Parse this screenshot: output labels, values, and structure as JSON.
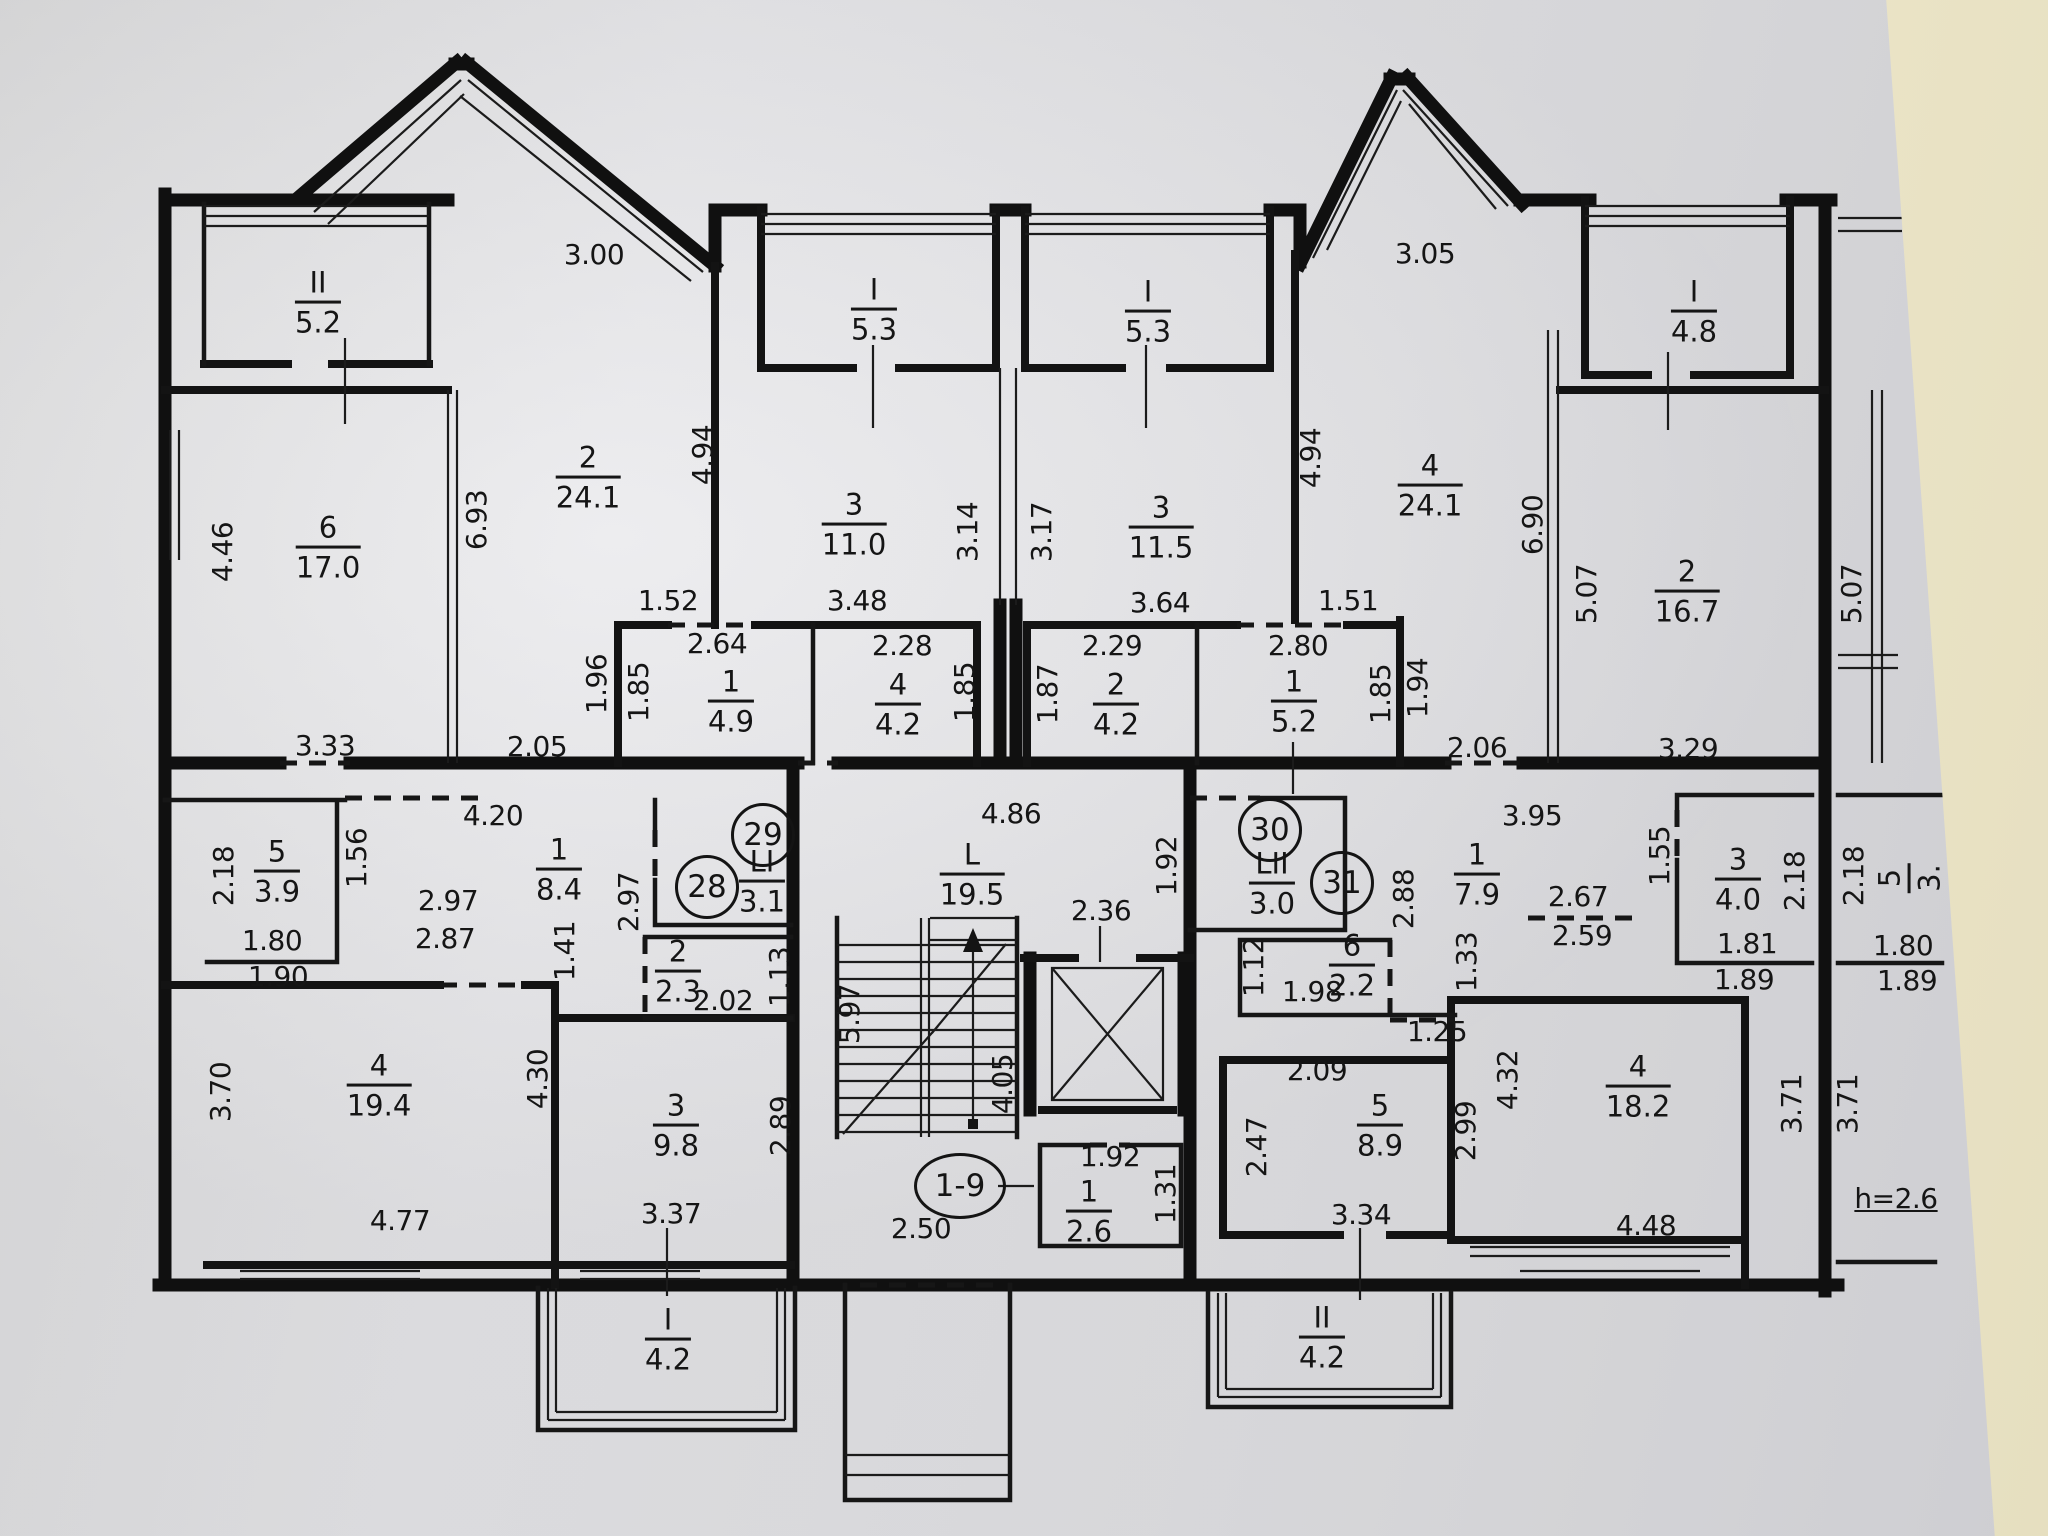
{
  "palette": {
    "paper": "#e3e3e6",
    "wall_behind": "#ece5c8",
    "ink": "#141414"
  },
  "ceiling_height": "h=2.6",
  "entrance": {
    "units": "1-9"
  },
  "apartment_numbers": {
    "a28": "28",
    "a29": "29",
    "a30": "30",
    "a31": "31"
  },
  "rooms": {
    "balcony_II_52": {
      "n": "II",
      "a": "5.2"
    },
    "loggia_I_53_left": {
      "n": "I",
      "a": "5.3"
    },
    "loggia_I_53_right": {
      "n": "I",
      "a": "5.3"
    },
    "balcony_I_48": {
      "n": "I",
      "a": "4.8"
    },
    "room6_170": {
      "n": "6",
      "a": "17.0"
    },
    "room2_241": {
      "n": "2",
      "a": "24.1"
    },
    "room3_110": {
      "n": "3",
      "a": "11.0"
    },
    "room3_115": {
      "n": "3",
      "a": "11.5"
    },
    "room4_241": {
      "n": "4",
      "a": "24.1"
    },
    "room2_167": {
      "n": "2",
      "a": "16.7"
    },
    "room1_49": {
      "n": "1",
      "a": "4.9"
    },
    "room4_42": {
      "n": "4",
      "a": "4.2"
    },
    "room2_42": {
      "n": "2",
      "a": "4.2"
    },
    "room1_52": {
      "n": "1",
      "a": "5.2"
    },
    "room5_39": {
      "n": "5",
      "a": "3.9"
    },
    "room1_84": {
      "n": "1",
      "a": "8.4"
    },
    "wc_LI": {
      "n": "LI",
      "a": "3.1"
    },
    "wc_LII": {
      "n": "LII",
      "a": "3.0"
    },
    "room1_79": {
      "n": "1",
      "a": "7.9"
    },
    "room2_23": {
      "n": "2",
      "a": "2.3"
    },
    "room6_22": {
      "n": "6",
      "a": "2.2"
    },
    "stair_L": {
      "n": "L",
      "a": "19.5"
    },
    "room4_194": {
      "n": "4",
      "a": "19.4"
    },
    "room3_98": {
      "n": "3",
      "a": "9.8"
    },
    "room1_26": {
      "n": "1",
      "a": "2.6"
    },
    "room5_89": {
      "n": "5",
      "a": "8.9"
    },
    "room4_182": {
      "n": "4",
      "a": "18.2"
    },
    "room3_40": {
      "n": "3",
      "a": "4.0"
    },
    "balcony_I_42": {
      "n": "I",
      "a": "4.2"
    },
    "balcony_II_42": {
      "n": "II",
      "a": "4.2"
    },
    "room_clipped": {
      "n": "5",
      "a": "3."
    }
  },
  "dims": {
    "d300": "3.00",
    "d305": "3.05",
    "d446": "4.46",
    "d693": "6.93",
    "d494a": "4.94",
    "d494b": "4.94",
    "d314": "3.14",
    "d317": "3.17",
    "d690": "6.90",
    "d507a": "5.07",
    "d507b": "5.07",
    "d152": "1.52",
    "d264": "2.64",
    "d348": "3.48",
    "d228": "2.28",
    "d364": "3.64",
    "d229": "2.29",
    "d151": "1.51",
    "d280": "2.80",
    "d196": "1.96",
    "d185a": "1.85",
    "d185b": "1.85",
    "d185c": "1.85",
    "d187": "1.87",
    "d194": "1.94",
    "d333": "3.33",
    "d205": "2.05",
    "d206": "2.06",
    "d329": "3.29",
    "d420": "4.20",
    "d395": "3.95",
    "d486": "4.86",
    "d218a": "2.18",
    "d218b": "2.18",
    "d218c": "2.18",
    "d156": "1.56",
    "d297a": "2.97",
    "d297b": "2.97",
    "d287": "2.87",
    "d180a": "1.80",
    "d180b": "1.80",
    "d190": "1.90",
    "d189a": "1.89",
    "d189b": "1.89",
    "d141": "1.41",
    "d202": "2.02",
    "d113": "1.13",
    "d192a": "1.92",
    "d192b": "1.92",
    "d288": "2.88",
    "d236": "2.36",
    "d267": "2.67",
    "d259": "2.59",
    "d155": "1.55",
    "d181": "1.81",
    "d112": "1.12",
    "d198": "1.98",
    "d125": "1.25",
    "d133": "1.33",
    "d370": "3.70",
    "d430": "4.30",
    "d289": "2.89",
    "d597": "5.97",
    "d405": "4.05",
    "d209": "2.09",
    "d247": "2.47",
    "d299": "2.99",
    "d432": "4.32",
    "d371a": "3.71",
    "d371b": "3.71",
    "d477": "4.77",
    "d337": "3.37",
    "d131": "1.31",
    "d250": "2.50",
    "d334": "3.34",
    "d448": "4.48"
  }
}
